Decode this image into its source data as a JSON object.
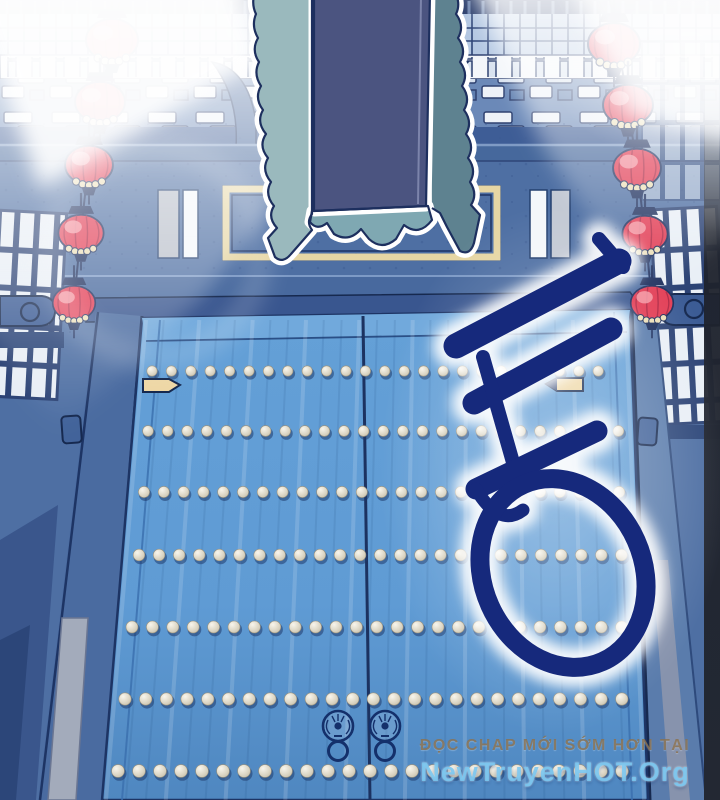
{
  "scene": {
    "type": "manhwa-panel",
    "description": "Night view of a large blue palace gate with studded double doors, strings of red lanterns on both sides, a tattered hanging banner, light beams, and a large Korean sound-effect calligraphy overlay"
  },
  "watermark": {
    "line1": "ĐỌC CHAP MỚI SỚM HƠN TẠI",
    "line2": "NewTruyenHOT.Org"
  },
  "calligraphy": {
    "character": "동",
    "ink": "#16297c",
    "glow": "#ffffff"
  },
  "palette": {
    "wall": "#4e6fa3",
    "door": "#5f9bd4",
    "doorDark": "#4f87c0",
    "outline": "#16294f",
    "stud": "#d9d4c4",
    "latch": "#eed7a6",
    "lanternRed": "#e23d55",
    "lanternHighlight": "#f59aa6",
    "lanternCap": "#1d2f5e",
    "bannerLeft": "#9ab9bd",
    "bannerPanel": "#4b5480",
    "bannerRight": "#5e8290",
    "bannerFringe": "#7fa8b2",
    "plaqueGold": "#e6d6a4",
    "beam": "#ffffff",
    "rightShadowStrip": "#232833"
  },
  "lanterns": {
    "left": [
      {
        "x": 112,
        "y": 40,
        "s": 1.0
      },
      {
        "x": 100,
        "y": 102,
        "s": 0.96
      },
      {
        "x": 89,
        "y": 165,
        "s": 0.92
      },
      {
        "x": 81,
        "y": 233,
        "s": 0.87
      },
      {
        "x": 74,
        "y": 303,
        "s": 0.82
      }
    ],
    "right": [
      {
        "x": 614,
        "y": 44,
        "s": 1.0
      },
      {
        "x": 628,
        "y": 105,
        "s": 0.96
      },
      {
        "x": 637,
        "y": 168,
        "s": 0.92
      },
      {
        "x": 645,
        "y": 234,
        "s": 0.87
      },
      {
        "x": 652,
        "y": 303,
        "s": 0.82
      }
    ]
  },
  "studRows": [
    {
      "y": 371,
      "x1": 152,
      "x2": 616,
      "sp": 19.4,
      "r": 5.2
    },
    {
      "y": 431,
      "x1": 148,
      "x2": 620,
      "sp": 19.6,
      "r": 5.4
    },
    {
      "y": 492,
      "x1": 144,
      "x2": 624,
      "sp": 19.8,
      "r": 5.6
    },
    {
      "y": 555,
      "x1": 139,
      "x2": 627,
      "sp": 20.1,
      "r": 5.8
    },
    {
      "y": 627,
      "x1": 132,
      "x2": 630,
      "sp": 20.4,
      "r": 6.0
    },
    {
      "y": 699,
      "x1": 125,
      "x2": 633,
      "sp": 20.7,
      "r": 6.2
    },
    {
      "y": 771,
      "x1": 118,
      "x2": 635,
      "sp": 21.0,
      "r": 6.4
    }
  ],
  "knockers": [
    {
      "x": 338,
      "y": 726
    },
    {
      "x": 385,
      "y": 726
    }
  ]
}
